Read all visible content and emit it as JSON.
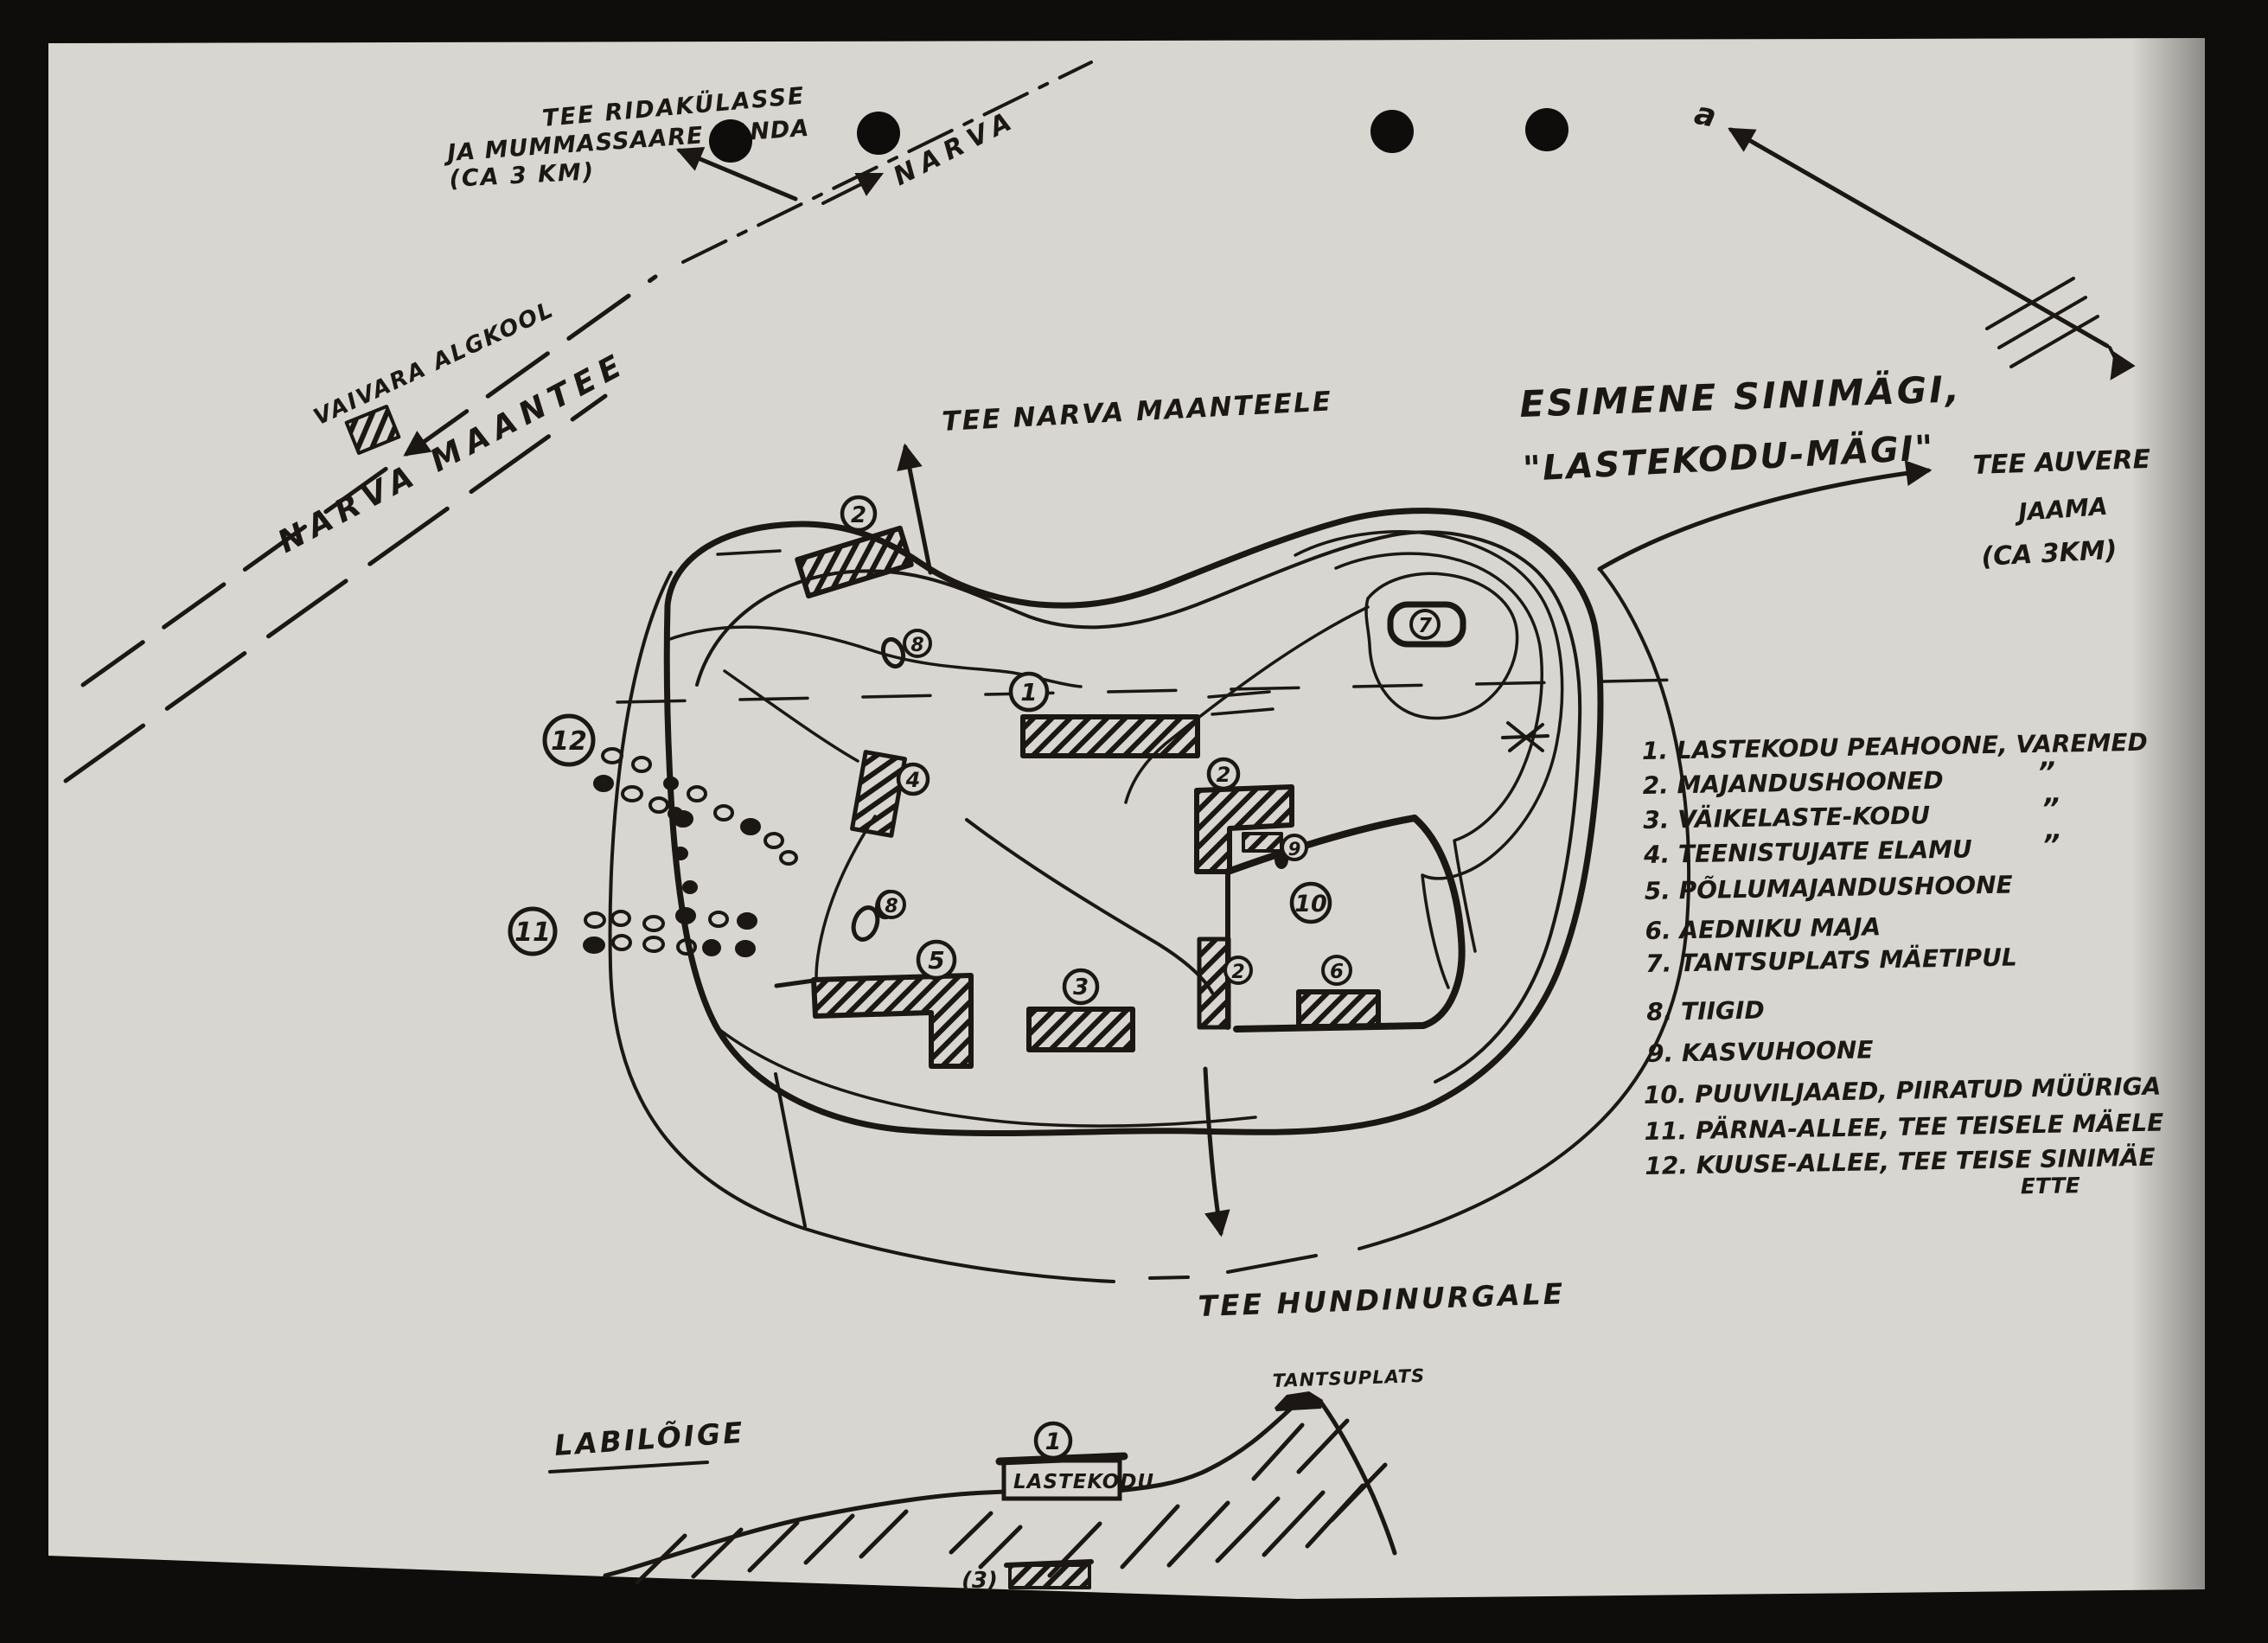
{
  "colors": {
    "paper": "#d8d6d0",
    "ink": "#1b1714",
    "scan-bg": "#0e0d0b"
  },
  "labels": {
    "road_ridakyla_line1": "TEE RIDAKÜLASSE",
    "road_ridakyla_line2": "JA MUMMASSAARE RANDA",
    "road_ridakyla_line3": "(CA 3 KM)",
    "narva": "NARVA",
    "vaivara_algkool": "VAIVARA ALGKOOL",
    "narva_maantee": "NARVA MAANTEE",
    "tee_narva_maanteele": "TEE NARVA MAANTEELE",
    "title_line1": "ESIMENE SINIMÄGI,",
    "title_line2": "\"LASTEKODU-MÄGI\"",
    "tee_auvere_line1": "TEE AUVERE",
    "tee_auvere_line2": "JAAMA",
    "tee_auvere_line3": "(CA 3KM)",
    "tee_hundinurgale": "TEE HUNDINURGALE",
    "labiloige": "LABILÕIGE",
    "lastekodu": "LASTEKODU",
    "tantsuplats": "TANTSUPLATS",
    "cross_section_item3": "(3)",
    "compass_mark": "a"
  },
  "legend": {
    "lines": [
      "1. LASTEKODU PEAHOONE, VAREMED",
      "2. MAJANDUSHOONED",
      "3. VÄIKELASTE-KODU",
      "4. TEENISTUJATE ELAMU",
      "5. PÕLLUMAJANDUSHOONE",
      "6. AEDNIKU MAJA",
      "7. TANTSUPLATS MÄETIPUL",
      "8. TIIGID",
      "9. KASVUHOONE",
      "10. PUUVILJAAED, PIIRATUD MÜÜRIGA",
      "11. PÄRNA-ALLEE, TEE TEISELE MÄELE",
      "12. KUUSE-ALLEE, TEE TEISE SINIMÄE",
      "ETTE"
    ],
    "ditto": "”"
  },
  "markers": {
    "n1": "1",
    "n2": "2",
    "n3": "3",
    "n4": "4",
    "n5": "5",
    "n6": "6",
    "n7": "7",
    "n8": "8",
    "n9": "9",
    "n10": "10",
    "n11": "11",
    "n12": "12"
  }
}
